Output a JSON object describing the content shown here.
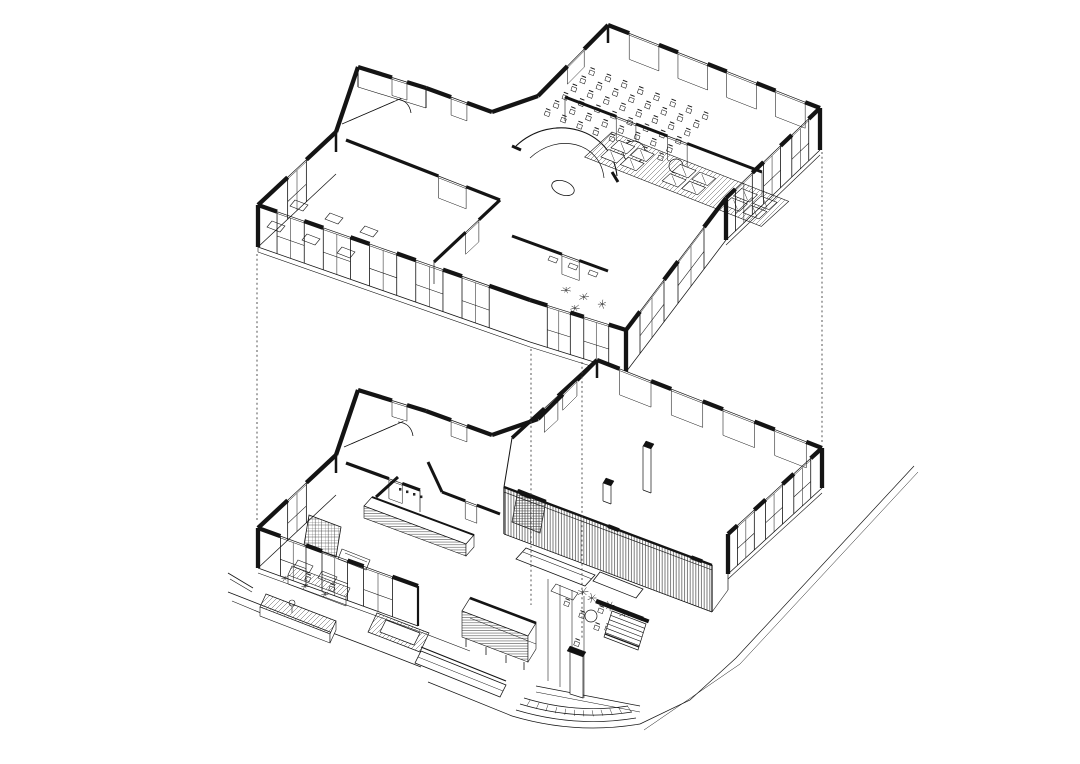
{
  "document": {
    "title": "Exploded axonometric drawing of a two-storey building",
    "type": "architectural line drawing, black ink on white",
    "background_color": "#ffffff",
    "ink_color": "#141414"
  },
  "levels": {
    "upper": {
      "name": "upper-floor-plan",
      "rooms": [
        "stair-block",
        "studio-with-desks",
        "round-foyer",
        "auditorium-with-chairs",
        "mat-room-with-carpet-runner",
        "washrooms-with-plants"
      ]
    },
    "lower": {
      "name": "lower-floor-plan",
      "rooms": [
        "stair-block",
        "service-counter-with-tiny-sign",
        "bookshelf-area",
        "double-height-hall-with-columns",
        "slatted-screen-lounge",
        "glass-entry-vestibule",
        "bar-counter",
        "outdoor-terrace"
      ]
    }
  },
  "counts": {
    "auditorium_chair_rows": 6,
    "auditorium_chair_cols": 8,
    "mat_clusters": 3,
    "mats_per_cluster": 4,
    "stair_steps": 7,
    "curved_step_arcs": 4,
    "hall_columns": 2,
    "back_wall_windows": 4,
    "east_wall_windows": 3,
    "projection_lines": 4
  },
  "sign": {
    "text": "",
    "note": "illegible miniature label above the service counter"
  }
}
